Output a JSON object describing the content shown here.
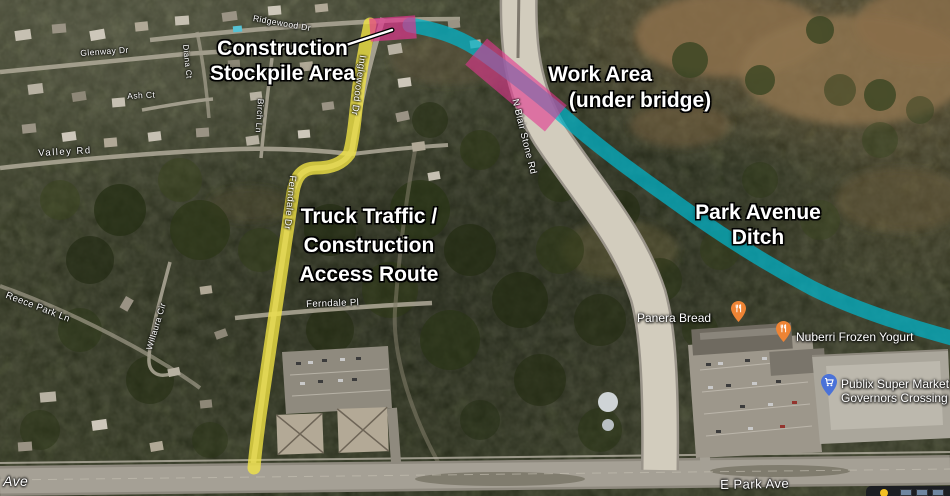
{
  "annotations": {
    "stockpile": {
      "line1": "Construction",
      "line2": "Stockpile Area"
    },
    "work_area": {
      "line1": "Work Area",
      "line2": "(under bridge)"
    },
    "truck_route": {
      "line1": "Truck Traffic /",
      "line2": "Construction",
      "line3": "Access Route"
    },
    "ditch": {
      "line1": "Park Avenue",
      "line2": "Ditch"
    }
  },
  "streets": [
    {
      "text": "Glenway Dr"
    },
    {
      "text": "Diana Ct"
    },
    {
      "text": "Ash Ct"
    },
    {
      "text": "Ridgewood Dr"
    },
    {
      "text": "Birch Ln"
    },
    {
      "text": "Inglewood Dr"
    },
    {
      "text": "Valley Rd"
    },
    {
      "text": "Reece Park Ln"
    },
    {
      "text": "Willaura Cir"
    },
    {
      "text": "Ferndale Dr"
    },
    {
      "text": "Ferndale Pl"
    },
    {
      "text": "N Blair Stone Rd"
    },
    {
      "text": "E Park Ave"
    },
    {
      "text": "k Ave"
    }
  ],
  "pois": [
    {
      "name": "Panera Bread",
      "icon": "restaurant",
      "pin_color": "#ee8435"
    },
    {
      "name": "Nuberri Frozen Yogurt",
      "icon": "restaurant",
      "pin_color": "#ee8435"
    },
    {
      "line1": "Publix Super Market",
      "line2": "Governors Crossing",
      "icon": "shopping-cart",
      "pin_color": "#4a72d8"
    }
  ],
  "overlays": {
    "truck_route_color": "#f4e544",
    "work_zone_color": "#e2358f",
    "ditch_color": "#00b5cc"
  }
}
